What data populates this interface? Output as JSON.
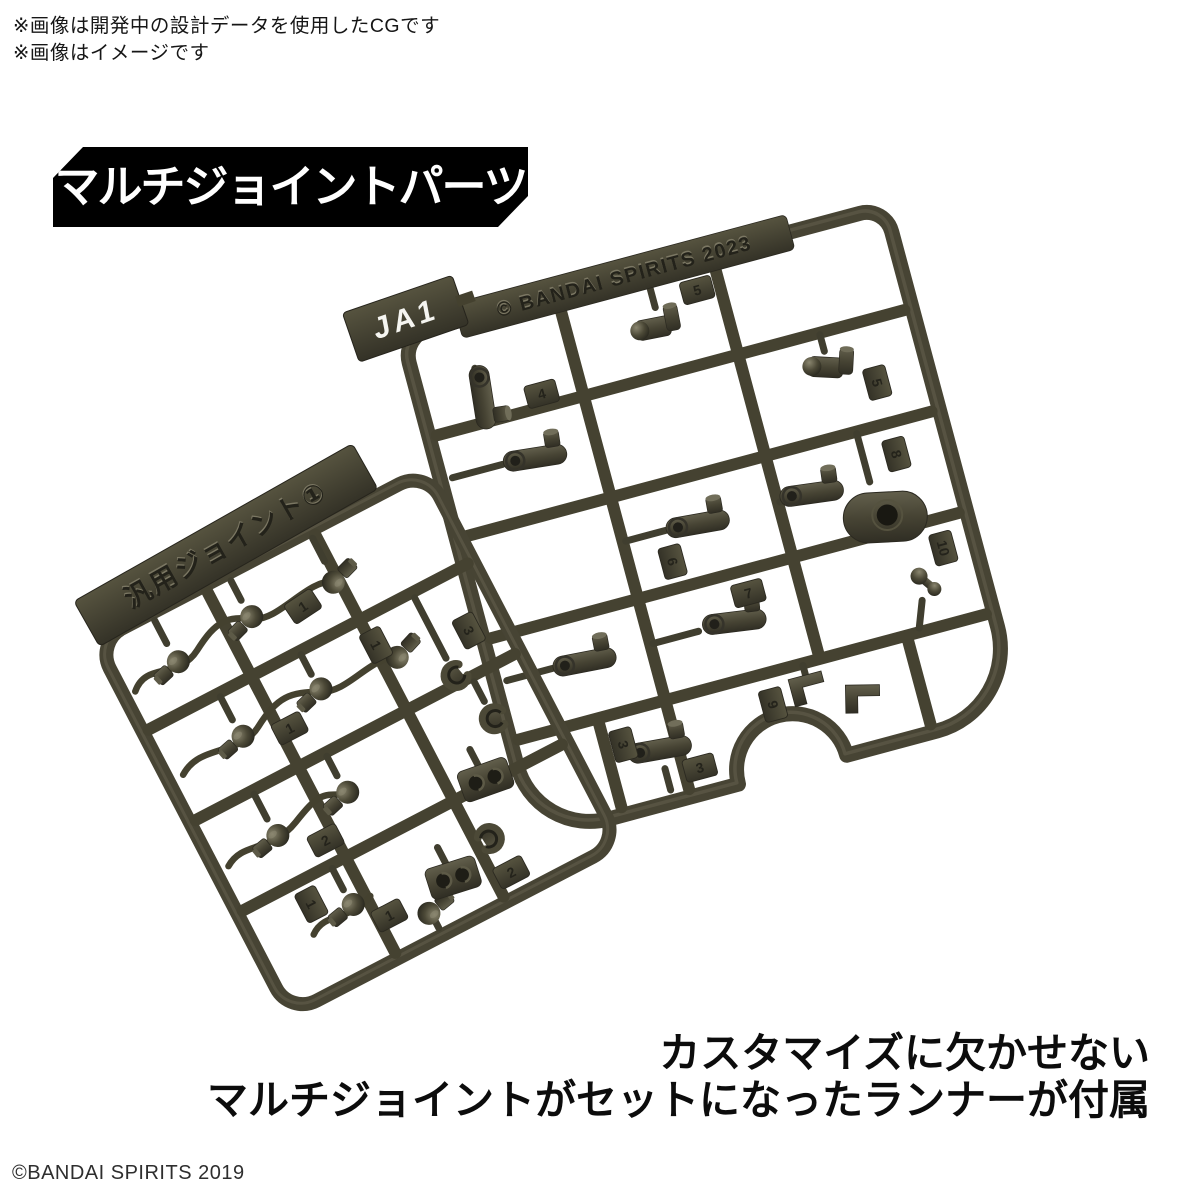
{
  "notes": {
    "line1": "※画像は開発中の設計データを使用したCGです",
    "line2": "※画像はイメージです"
  },
  "banner": {
    "label": "マルチジョイントパーツ",
    "background": "#000000",
    "text_color": "#ffffff"
  },
  "render": {
    "plastic_color": "#474434",
    "right_runner": {
      "gate_code": "JA1",
      "molding_text": "© BANDAI SPIRITS 2023",
      "tags": [
        "4",
        "5",
        "5",
        "6",
        "7",
        "8",
        "9",
        "10",
        "3",
        "3"
      ]
    },
    "left_runner": {
      "plate_text": "汎用ジョイント①",
      "tags": [
        "1",
        "1",
        "1",
        "2",
        "1",
        "2",
        "3",
        "1"
      ]
    }
  },
  "caption": {
    "line1": "カスタマイズに欠かせない",
    "line2": "マルチジョイントがセットになったランナーが付属"
  },
  "footer": {
    "copyright": "©BANDAI SPIRITS 2019"
  }
}
